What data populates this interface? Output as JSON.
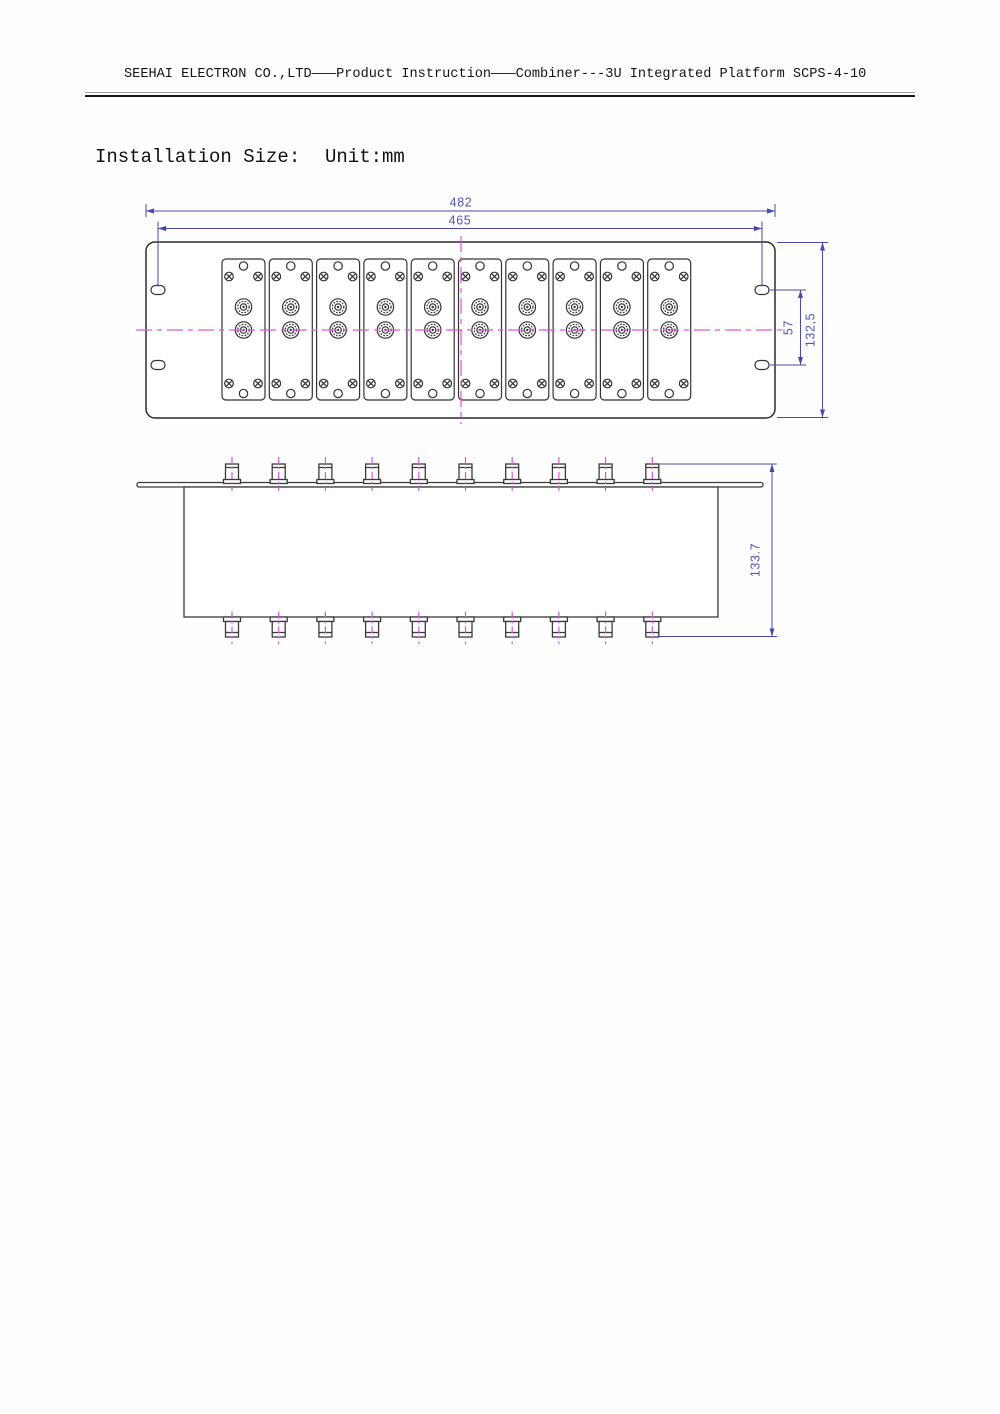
{
  "header": {
    "title": "SEEHAI ELECTRON CO.,LTD———Product Instruction———Combiner---3U Integrated Platform SCPS-4-10"
  },
  "section": {
    "title": "Installation Size:",
    "unit_label": "Unit:mm"
  },
  "colors": {
    "dimension_line": "#4848ae",
    "dimension_text": "#5353b8",
    "centerline_magenta": "#dd55dd",
    "drawing_outline": "#333333"
  },
  "front_view": {
    "description": "front panel view with 10 plug-in modules",
    "module_count": 10,
    "connectors_per_module": 2,
    "screws_per_module": 4,
    "mounting_slot_count": 4,
    "dimensions": [
      {
        "label": "482"
      },
      {
        "label": "465"
      },
      {
        "label": "57"
      },
      {
        "label": "132,5"
      }
    ]
  },
  "side_view": {
    "description": "side view with connectors on both faces",
    "top_connector_count": 10,
    "bottom_connector_count": 10,
    "dimensions": [
      {
        "label": "133.7"
      }
    ]
  }
}
